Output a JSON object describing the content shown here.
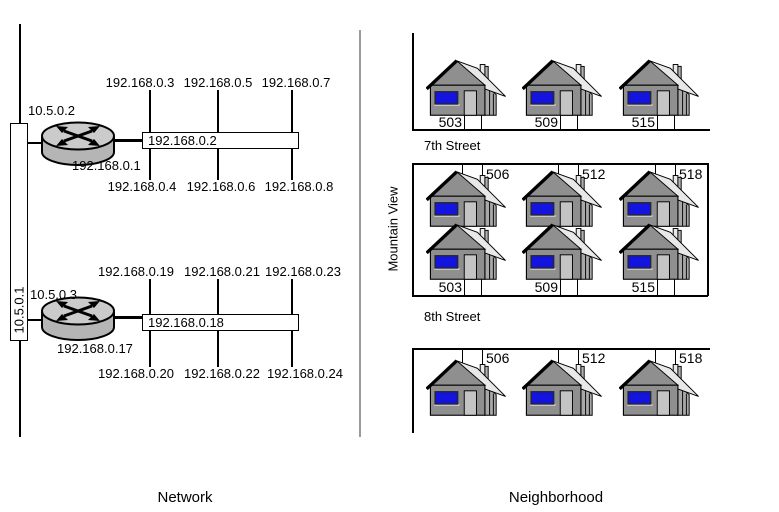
{
  "captions": {
    "left": "Network",
    "right": "Neighborhood"
  },
  "network": {
    "backbone_ip": "10.5.0.1",
    "clusters": [
      {
        "router_ip": "10.5.0.2",
        "router_lan_ip": "192.168.0.1",
        "segment_ip": "192.168.0.2",
        "hosts_top": [
          "192.168.0.3",
          "192.168.0.5",
          "192.168.0.7"
        ],
        "hosts_bottom": [
          "192.168.0.4",
          "192.168.0.6",
          "192.168.0.8"
        ]
      },
      {
        "router_ip": "10.5.0.3",
        "router_lan_ip": "192.168.0.17",
        "segment_ip": "192.168.0.18",
        "hosts_top": [
          "192.168.0.19",
          "192.168.0.21",
          "192.168.0.23"
        ],
        "hosts_bottom": [
          "192.168.0.20",
          "192.168.0.22",
          "192.168.0.24"
        ]
      }
    ]
  },
  "neighborhood": {
    "area_label": "Mountain View",
    "streets": [
      {
        "name": "7th Street"
      },
      {
        "name": "8th Street"
      }
    ],
    "blocks": {
      "north_7th": [
        "503",
        "509",
        "515"
      ],
      "south_7th": [
        "506",
        "512",
        "518"
      ],
      "north_8th": [
        "503",
        "509",
        "515"
      ],
      "south_8th": [
        "506",
        "512",
        "518"
      ]
    }
  },
  "colors": {
    "line_black": "#000000",
    "divider_gray": "#9a9a9a",
    "router_top": "#cbcbcb",
    "router_side": "#b5b5b5",
    "house_body": "#8f8f8f",
    "house_roof": "#e8e8e8",
    "house_side": "#a8a8a8",
    "house_door": "#c4c4c4",
    "window_blue": "#1414e0"
  }
}
